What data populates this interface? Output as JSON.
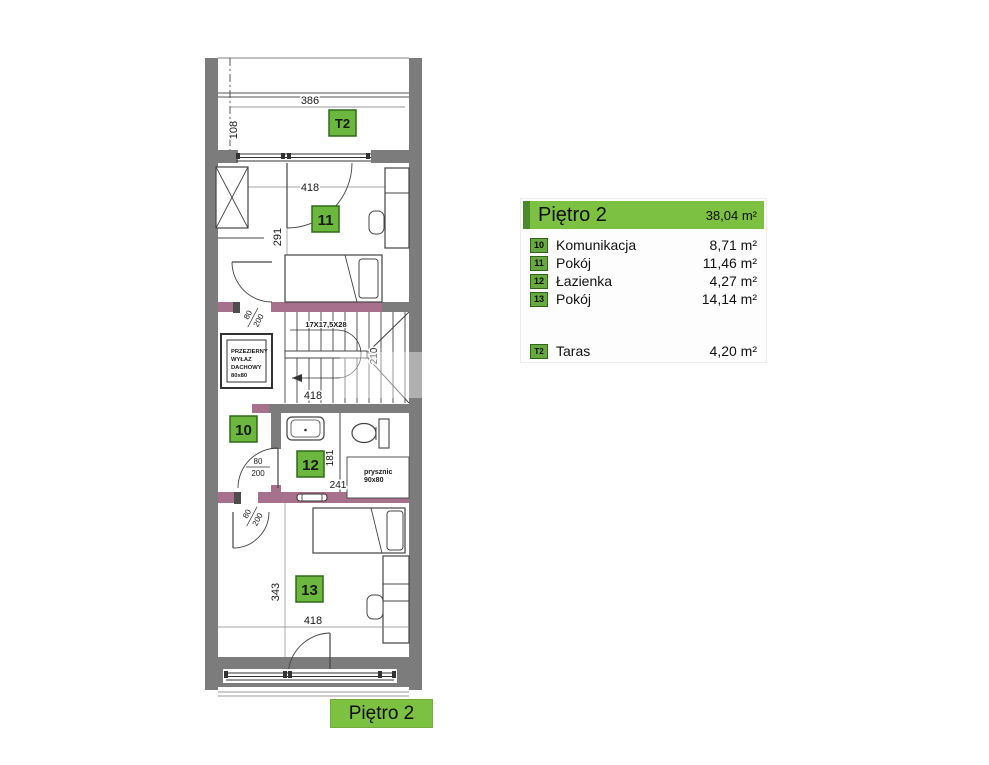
{
  "colors": {
    "green": "#7cc142",
    "green_dark": "#4a8a2b",
    "badge_green": "#6cb83f",
    "badge_border": "#2e6b17",
    "wall_gray": "#7c7c7c",
    "accent_purple": "#a7708c"
  },
  "legend": {
    "title": "Piętro 2",
    "total_area": "38,04 m²",
    "rows": [
      {
        "badge": "10",
        "name": "Komunikacja",
        "area": "8,71 m²"
      },
      {
        "badge": "11",
        "name": "Pokój",
        "area": "11,46 m²"
      },
      {
        "badge": "12",
        "name": "Łazienka",
        "area": "4,27 m²"
      },
      {
        "badge": "13",
        "name": "Pokój",
        "area": "14,14 m²"
      }
    ],
    "terrace_row": {
      "badge": "T2",
      "name": "Taras",
      "area": "4,20 m²"
    }
  },
  "footer": {
    "label": "Piętro 2"
  },
  "plan": {
    "badges": {
      "t2": "T2",
      "r10": "10",
      "r11": "11",
      "r12": "12",
      "r13": "13"
    },
    "dimensions": {
      "terrace_width": "386",
      "terrace_depth": "108",
      "room11_width": "418",
      "room11_depth": "291",
      "stairs_steps": "17X17,5X28",
      "stairs_width": "418",
      "stairs_opening": "210",
      "bath_depth": "181",
      "bath_width": "241",
      "room13_depth": "343",
      "room13_width": "418",
      "door_width": "80",
      "door_height": "200"
    },
    "labels": {
      "hatch_line1": "PRZEZIERNY",
      "hatch_line2": "WYŁAZ",
      "hatch_line3": "DACHOWY",
      "hatch_line4": "80x80",
      "shower_line1": "prysznic",
      "shower_line2": "90x80"
    }
  }
}
